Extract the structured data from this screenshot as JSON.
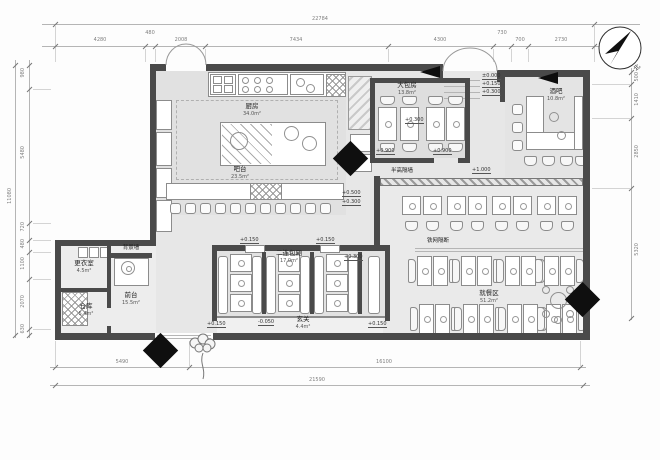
{
  "compass": {
    "label": "北"
  },
  "rooms": {
    "kitchen": {
      "name": "厨房",
      "area": "34.0m²"
    },
    "bar_counter": {
      "name": "吧台",
      "area": "23.5m²"
    },
    "large_room": {
      "name": "大包房",
      "area": "13.8m²"
    },
    "pub_bar": {
      "name": "酒吧",
      "area": "10.8m²"
    },
    "dining": {
      "name": "就餐区",
      "area": "51.2m²"
    },
    "booths": {
      "name": "二连包厢",
      "area": "17.0m²"
    },
    "foyer": {
      "name": "玄关",
      "area": "4.4m²"
    },
    "changing": {
      "name": "更衣室",
      "area": "4.5m²"
    },
    "reception": {
      "name": "前台",
      "area": "15.5m²"
    },
    "storage": {
      "name": "仓库",
      "area": "5.4m²"
    }
  },
  "annotations": {
    "half_wall": "半高隔墙",
    "mesh_partition": "铁网隔断",
    "bg_wall": "背景墙"
  },
  "elevations": {
    "e1": "+0.500",
    "e2": "+0.300",
    "e3": "+1.000",
    "e4": "±0.000",
    "e5": "+0.150",
    "e6": "+0.300",
    "e7": "+0.300",
    "e8": "+0.900",
    "e9": "+0.900",
    "e10": "+0.150",
    "e11": "+0.150",
    "e12": "+0.300",
    "e13": "-0.050",
    "e14": "+0.150",
    "e15": "+0.150"
  },
  "dimensions": {
    "top_total": "22784",
    "top_segments": [
      "4280",
      "480",
      "2008",
      "7434",
      "4300",
      "730",
      "700",
      "2730"
    ],
    "bottom_total": "21590",
    "bottom_segments": [
      "5490",
      "16100"
    ],
    "left_total": "11080",
    "left_segments": [
      "980",
      "5480",
      "720",
      "480",
      "1100",
      "2070",
      "630"
    ],
    "right_segments": [
      "500",
      "1410",
      "2850",
      "5320"
    ]
  }
}
